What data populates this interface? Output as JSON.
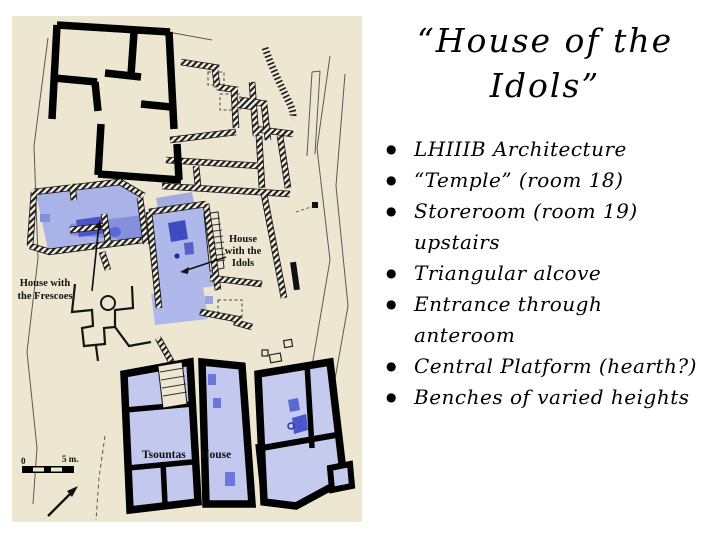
{
  "slide": {
    "title_lines": [
      "“House of the",
      "Idols”"
    ],
    "bullets": [
      "LHIIIB Architecture",
      "“Temple” (room 18)",
      "Storeroom (room 19)\nupstairs",
      "Triangular alcove",
      "Entrance through\nanteroom",
      "Central Platform (hearth?)",
      "Benches of varied heights"
    ]
  },
  "map": {
    "labels": {
      "idols": [
        "House",
        "with the",
        "Idols"
      ],
      "frescoes": [
        "House with",
        "the Frescoes"
      ],
      "tsountas": "Tsountas House",
      "scale_zero": "0",
      "scale_five": "5 m."
    },
    "colors": {
      "map_background": "#EDE7D2",
      "room_light": "#AFB8EA",
      "room_light_tsountas": "#C3C9EE",
      "room_mid": "#8490DC",
      "feature_dark": "#4A55C8",
      "wall_black": "#000000",
      "slide_background": "#FFFFFF"
    }
  }
}
